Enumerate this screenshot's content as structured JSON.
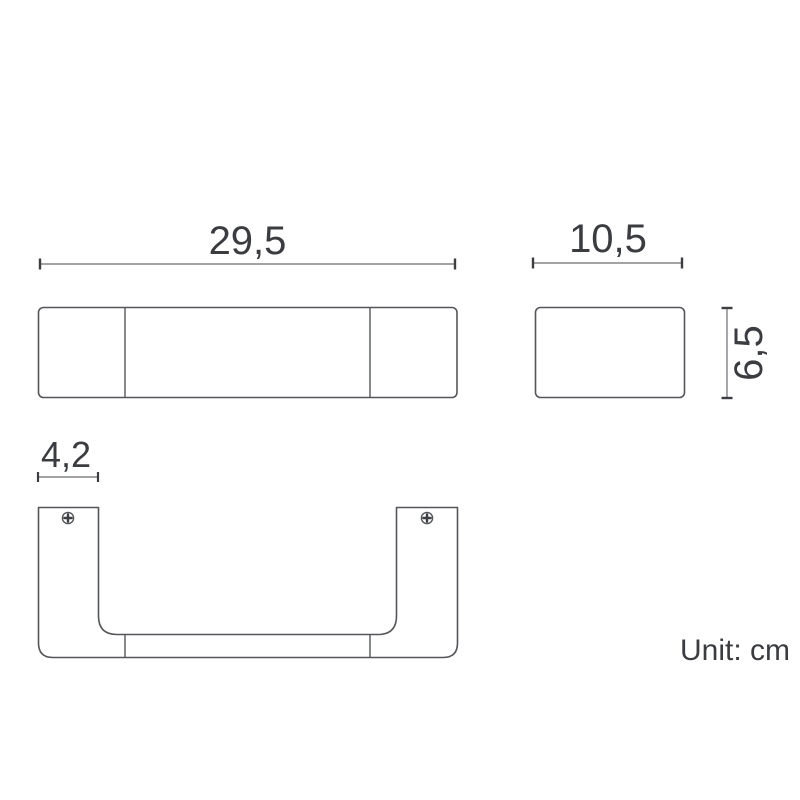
{
  "drawing": {
    "title": "towel-bar-dimension-diagram",
    "unit_note": "Unit: cm",
    "labels": {
      "front_width": "29,5",
      "side_width": "10,5",
      "side_height": "6,5",
      "mount_width": "4,2"
    },
    "dimensions_cm": {
      "front_width": 29.5,
      "side_width": 10.5,
      "side_height": 6.5,
      "mount_width": 4.2
    },
    "views": [
      {
        "name": "front-view",
        "description": "front elevation of bar with two end-cap dividers"
      },
      {
        "name": "side-view",
        "description": "side profile rectangle"
      },
      {
        "name": "bottom-view",
        "description": "U-shaped top/bottom view with two mounting screws"
      }
    ],
    "icons": [
      {
        "name": "screw-icon",
        "count": 2,
        "style": "phillips head circle with cross"
      }
    ],
    "colors": {
      "background": "#ffffff",
      "line": "#54565b",
      "dim_line": "#6a6c70",
      "dim_cap": "#3c3e43",
      "text": "#3a3c41"
    }
  }
}
